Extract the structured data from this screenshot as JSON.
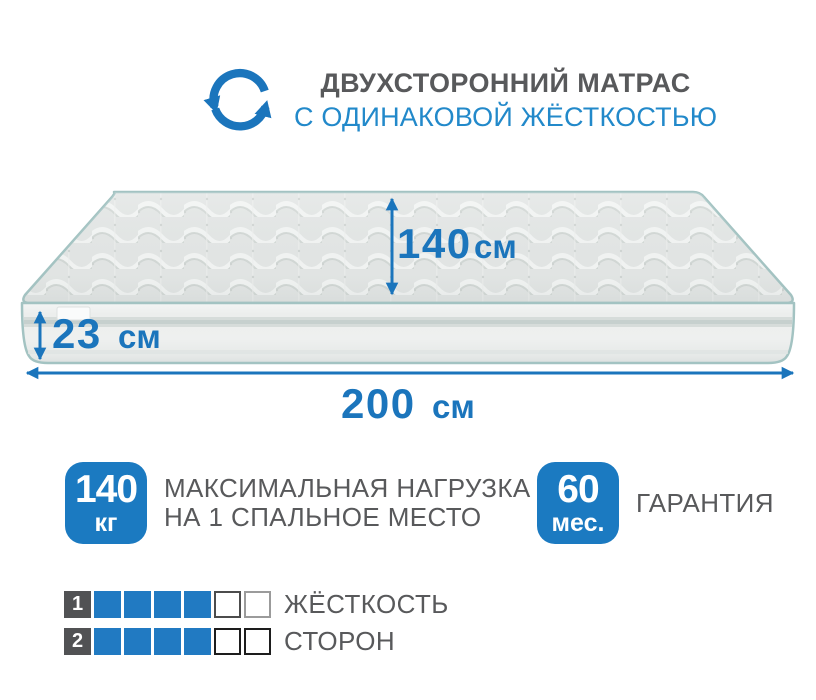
{
  "colors": {
    "accent-blue": "#1b75bc",
    "subtitle-blue": "#2289ca",
    "badge-blue": "#1b7ac1",
    "square-blue": "#217ac2",
    "text-gray": "#58595b",
    "number-square-gray": "#515254",
    "piping-teal": "#a3c3c2"
  },
  "header": {
    "title": "ДВУХСТОРОННИЙ МАТРАС",
    "subtitle": "С ОДИНАКОВОЙ ЖЁСТКОСТЬЮ",
    "icon": "rotate-arrows-icon"
  },
  "mattress": {
    "dimensions": {
      "width": {
        "value": "140",
        "unit": "см"
      },
      "height": {
        "value": "23",
        "unit": "см"
      },
      "length": {
        "value": "200",
        "unit": "см"
      }
    }
  },
  "features": [
    {
      "badge_value": "140",
      "badge_unit": "кг",
      "label_line1": "МАКСИМАЛЬНАЯ НАГРУЗКА",
      "label_line2": "НА 1 СПАЛЬНОЕ МЕСТО"
    },
    {
      "badge_value": "60",
      "badge_unit": "мес.",
      "label_line1": "ГАРАНТИЯ"
    }
  ],
  "ratings": {
    "rows": [
      {
        "number": "1",
        "label": "ЖЁСТКОСТЬ",
        "filled": 4,
        "total": 6,
        "cells": [
          "filled",
          "filled",
          "filled",
          "filled",
          "empty-dark",
          "empty-light"
        ]
      },
      {
        "number": "2",
        "label": "СТОРОН",
        "filled": 4,
        "total": 6,
        "cells": [
          "filled",
          "filled",
          "filled",
          "filled",
          "empty-black",
          "empty-black"
        ]
      }
    ]
  }
}
